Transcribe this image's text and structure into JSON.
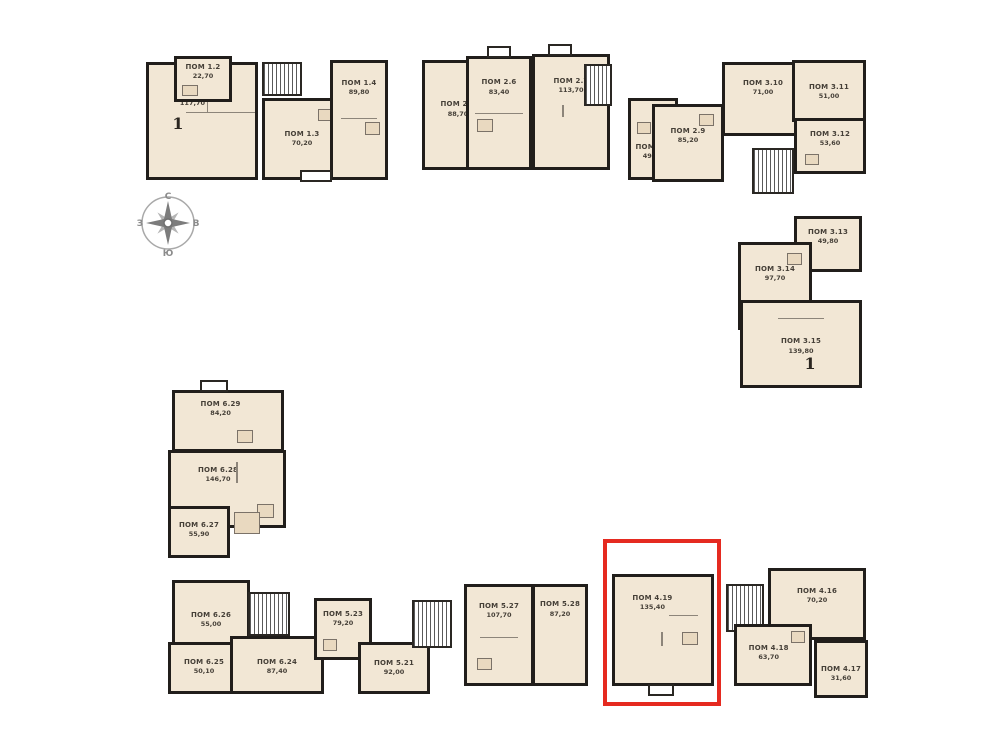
{
  "drawing": {
    "type": "floor-plan",
    "language": "ru",
    "wall_color": "#211e1b",
    "floor_color": "#f2e7d5",
    "highlight_color": "#e52a20",
    "highlighted_unit": "ПОМ 4.19"
  },
  "compass": {
    "north": "С",
    "east": "В",
    "south": "Ю",
    "west": "З"
  },
  "units": {
    "u1_1": {
      "name": "ПОМ 1.1",
      "area": "117,70",
      "mark": "1"
    },
    "u1_2": {
      "name": "ПОМ 1.2",
      "area": "22,70"
    },
    "u1_3": {
      "name": "ПОМ 1.3",
      "area": "70,20"
    },
    "u1_4": {
      "name": "ПОМ 1.4",
      "area": "89,80"
    },
    "u2_5": {
      "name": "ПОМ 2.5",
      "area": "88,70"
    },
    "u2_6": {
      "name": "ПОМ 2.6",
      "area": "83,40"
    },
    "u2_7": {
      "name": "ПОМ 2.7",
      "area": "113,70"
    },
    "u2_8": {
      "name": "ПОМ 2.8",
      "area": "49,60"
    },
    "u2_9": {
      "name": "ПОМ 2.9",
      "area": "85,20"
    },
    "u3_10": {
      "name": "ПОМ 3.10",
      "area": "71,00"
    },
    "u3_11": {
      "name": "ПОМ 3.11",
      "area": "51,00"
    },
    "u3_12": {
      "name": "ПОМ 3.12",
      "area": "53,60"
    },
    "u3_13": {
      "name": "ПОМ 3.13",
      "area": "49,80"
    },
    "u3_14": {
      "name": "ПОМ 3.14",
      "area": "97,70"
    },
    "u3_15": {
      "name": "ПОМ 3.15",
      "area": "139,80",
      "mark": "1"
    },
    "u6_29": {
      "name": "ПОМ 6.29",
      "area": "84,20"
    },
    "u6_28": {
      "name": "ПОМ 6.28",
      "area": "146,70"
    },
    "u6_27": {
      "name": "ПОМ 6.27",
      "area": "55,90"
    },
    "u6_26": {
      "name": "ПОМ 6.26",
      "area": "55,00"
    },
    "u6_25": {
      "name": "ПОМ 6.25",
      "area": "50,10"
    },
    "u6_24": {
      "name": "ПОМ 6.24",
      "area": "87,40"
    },
    "u5_23": {
      "name": "ПОМ 5.23",
      "area": "79,20"
    },
    "u5_21": {
      "name": "ПОМ 5.21",
      "area": "92,00"
    },
    "u5_27": {
      "name": "ПОМ 5.27",
      "area": "107,70"
    },
    "u5_28": {
      "name": "ПОМ 5.28",
      "area": "87,20"
    },
    "u4_19": {
      "name": "ПОМ 4.19",
      "area": "135,40"
    },
    "u4_16": {
      "name": "ПОМ 4.16",
      "area": "70,20"
    },
    "u4_18": {
      "name": "ПОМ 4.18",
      "area": "63,70"
    },
    "u4_17": {
      "name": "ПОМ 4.17",
      "area": "31,60"
    }
  }
}
